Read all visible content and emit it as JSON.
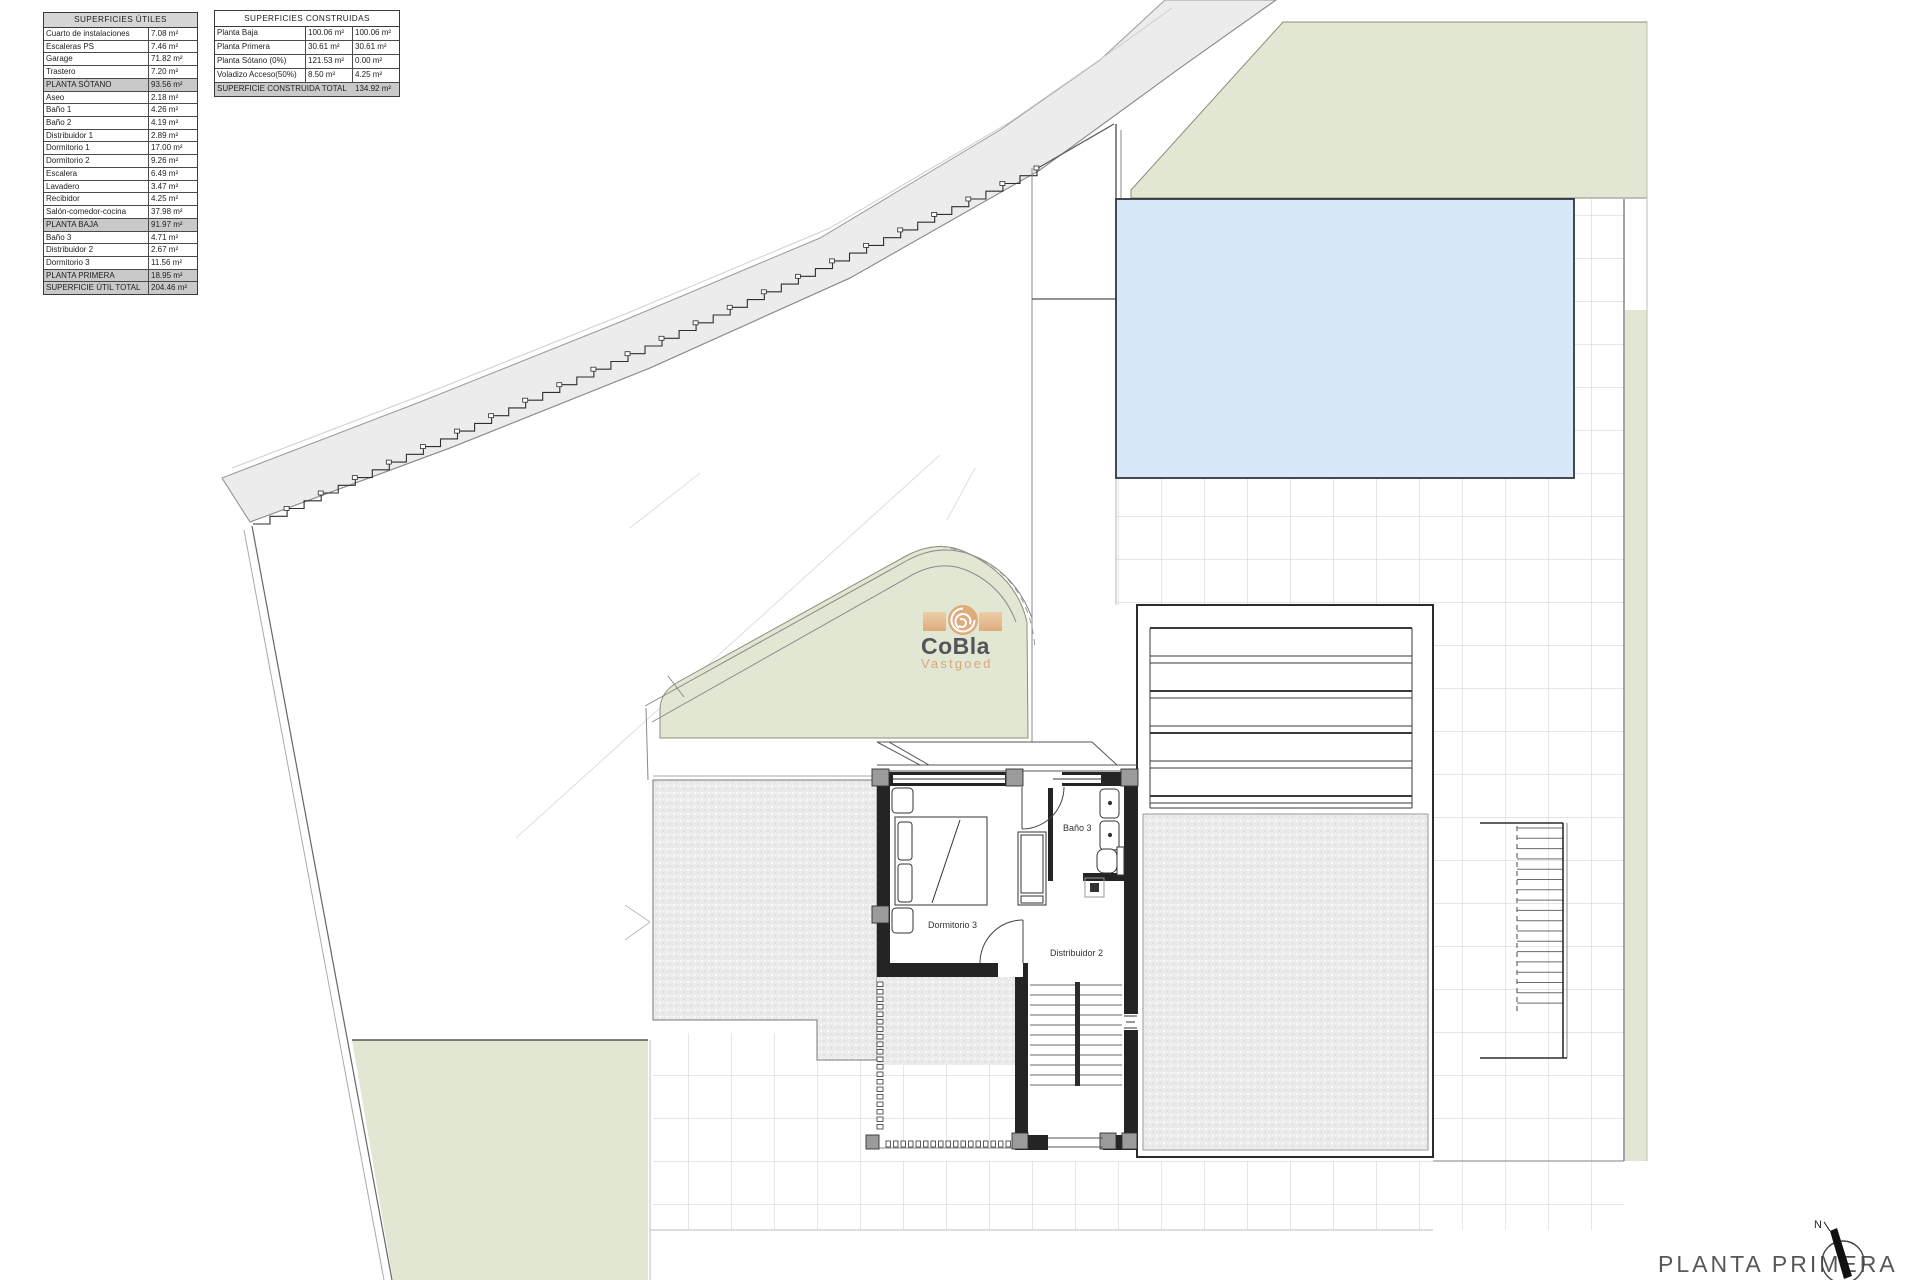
{
  "plan": {
    "title": "PLANTA PRIMERA",
    "north_label": "N",
    "rooms": {
      "bath": "Baño 3",
      "bedroom": "Dormitorio 3",
      "hall": "Distribuidor 2"
    }
  },
  "logo": {
    "name": "CoBla",
    "sub": "Vastgoed"
  },
  "tables": {
    "utiles": {
      "title": "SUPERFICIES ÚTILES",
      "rows": [
        {
          "label": "Cuarto de instalaciones",
          "value": "7.08 m²",
          "type": "item"
        },
        {
          "label": "Escaleras PS",
          "value": "7.46 m²",
          "type": "item"
        },
        {
          "label": "Garage",
          "value": "71.82 m²",
          "type": "item"
        },
        {
          "label": "Trastero",
          "value": "7.20 m²",
          "type": "item"
        },
        {
          "label": "PLANTA SÓTANO",
          "value": "93.56 m²",
          "type": "section"
        },
        {
          "label": "Aseo",
          "value": "2.18 m²",
          "type": "item"
        },
        {
          "label": "Baño 1",
          "value": "4.26 m²",
          "type": "item"
        },
        {
          "label": "Baño 2",
          "value": "4.19 m²",
          "type": "item"
        },
        {
          "label": "Distribuidor 1",
          "value": "2.89 m²",
          "type": "item"
        },
        {
          "label": "Dormitorio 1",
          "value": "17.00 m²",
          "type": "item"
        },
        {
          "label": "Dormitorio 2",
          "value": "9.26 m²",
          "type": "item"
        },
        {
          "label": "Escalera",
          "value": "6.49 m²",
          "type": "item"
        },
        {
          "label": "Lavadero",
          "value": "3.47 m²",
          "type": "item"
        },
        {
          "label": "Recibidor",
          "value": "4.25 m²",
          "type": "item"
        },
        {
          "label": "Salón-comedor-cocina",
          "value": "37.98 m²",
          "type": "item"
        },
        {
          "label": "PLANTA BAJA",
          "value": "91.97 m²",
          "type": "section"
        },
        {
          "label": "Baño 3",
          "value": "4.71 m²",
          "type": "item"
        },
        {
          "label": "Distribuidor 2",
          "value": "2.67 m²",
          "type": "item"
        },
        {
          "label": "Dormitorio 3",
          "value": "11.56 m²",
          "type": "item"
        },
        {
          "label": "PLANTA PRIMERA",
          "value": "18.95 m²",
          "type": "section"
        },
        {
          "label": "SUPERFICIE ÚTIL TOTAL",
          "value": "204.46 m²",
          "type": "section"
        }
      ]
    },
    "construidas": {
      "title": "SUPERFICIES CONSTRUIDAS",
      "rows": [
        {
          "label": "Planta Baja",
          "v1": "100.06 m²",
          "v2": "100.06 m²"
        },
        {
          "label": "Planta Primera",
          "v1": "30.61 m²",
          "v2": "30.61 m²"
        },
        {
          "label": "Planta Sótano (0%)",
          "v1": "121.53 m²",
          "v2": "0.00 m²"
        },
        {
          "label": "Voladizo Acceso(50%)",
          "v1": "8.50 m²",
          "v2": "4.25 m²"
        }
      ],
      "total": {
        "label": "SUPERFICIE CONSTRUIDA TOTAL",
        "value": "134.92 m²"
      }
    }
  },
  "colors": {
    "green": "#e2e7d4",
    "pool": "#d7e9f8",
    "road": "#ececec",
    "wall": "#242424",
    "pier": "#9b9b9b",
    "logo_tan": "#dfab7d",
    "logo_gray": "#54555a"
  }
}
